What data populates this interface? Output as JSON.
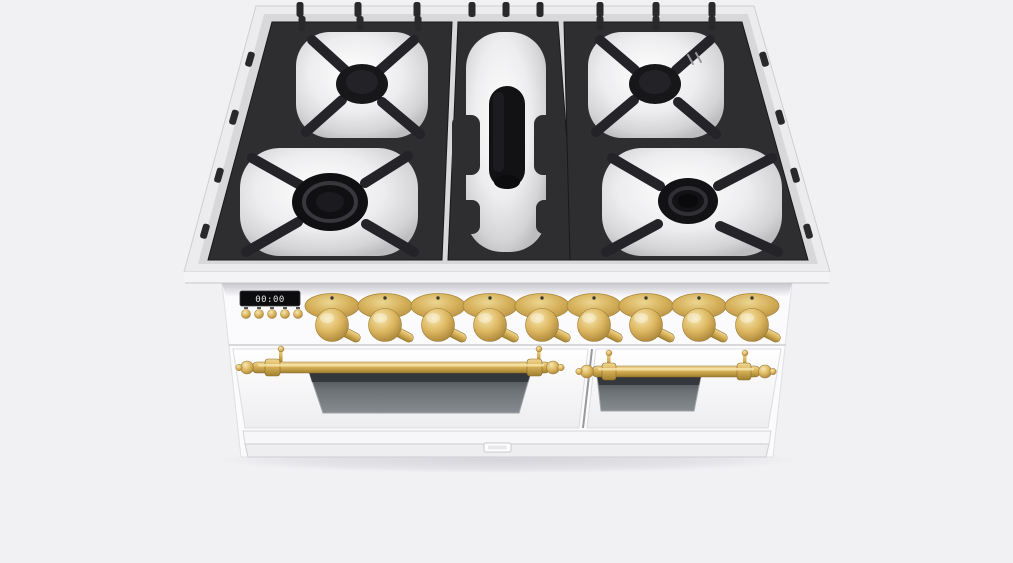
{
  "page": {
    "background_color": "#f1f1f4"
  },
  "product": {
    "name": "Freestanding double-oven gas range, white body with brass trim, viewed from front-above",
    "body_color": "#fbfbfd",
    "trim_color": "#dcb765",
    "grate_color": "#2e2e31",
    "cooktop": {
      "burner_count": 5,
      "grate_sections": 3,
      "burners": [
        "rear-left round burner",
        "front-left dual-ring burner",
        "center oval griddle burner",
        "rear-right round burner",
        "front-right round burner"
      ]
    },
    "control_panel": {
      "display": {
        "value": "00:00",
        "bg_color": "#0c0c0e"
      },
      "button_count": 5,
      "knob_count": 9,
      "knob_color": "#ddba68"
    },
    "ovens": {
      "door_count": 2,
      "handle_color": "#d9b158",
      "left_door_window": "tinted glass",
      "right_door_window": "tinted glass"
    },
    "kickplate": {
      "badge": ""
    }
  }
}
